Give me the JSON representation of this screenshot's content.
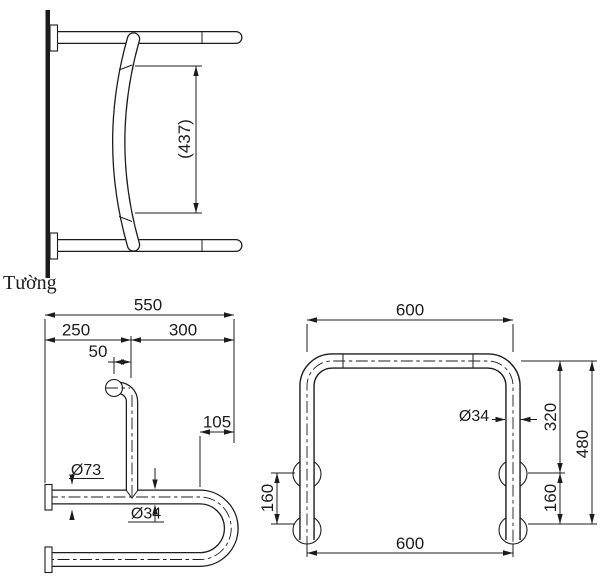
{
  "colors": {
    "line": "#1c1c1c",
    "background": "#ffffff"
  },
  "side_view": {
    "dim_height": "(437)",
    "wall_label": "Tường"
  },
  "plan_view": {
    "dim_total": "550",
    "dim_left": "250",
    "dim_right": "300",
    "dim_offset": "50",
    "dim_end": "105",
    "dia_flange": "Ø73",
    "dia_tube": "Ø34"
  },
  "front_view": {
    "dim_width_top": "600",
    "dim_width_bottom": "600",
    "dia_tube": "Ø34",
    "dim_upper": "320",
    "dim_total_height": "480",
    "dim_spacing_right": "160",
    "dim_spacing_left": "160"
  }
}
